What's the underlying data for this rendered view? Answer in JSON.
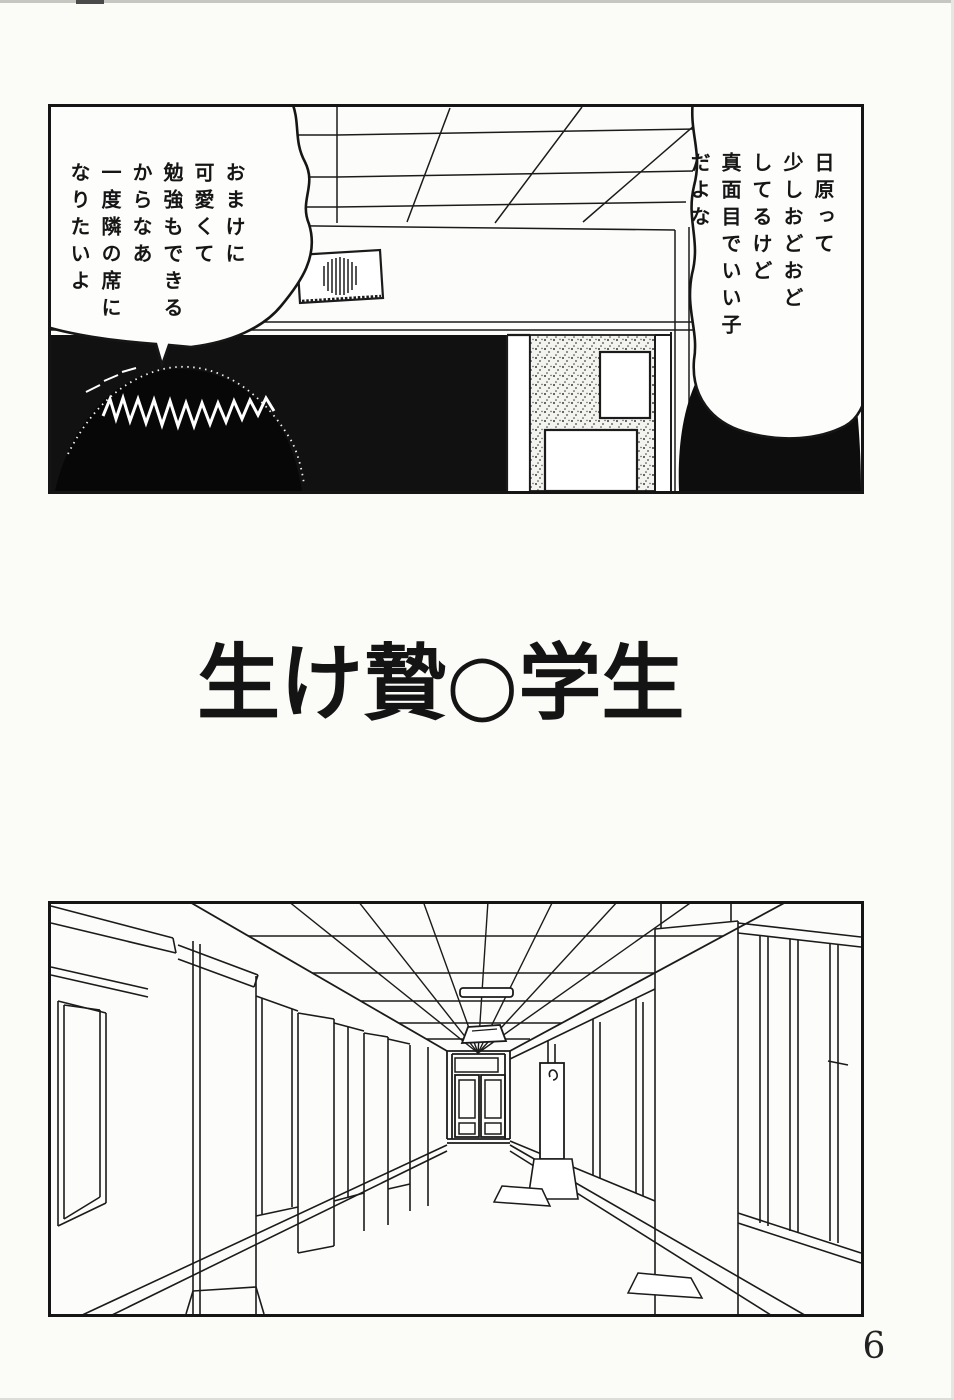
{
  "page": {
    "number": "6",
    "title": "生け贄○学生"
  },
  "panel_classroom": {
    "bubble_right": "日原って\n少しおどおど\nしてるけど\n真面目でいい子\nだよな",
    "bubble_left": "おまけに\n可愛くて\n勉強もできる\nからなあ\n一度隣の席に\nなりたいよ"
  },
  "colors": {
    "ink": "#1a1a1a",
    "paper": "#fbfbf8"
  }
}
